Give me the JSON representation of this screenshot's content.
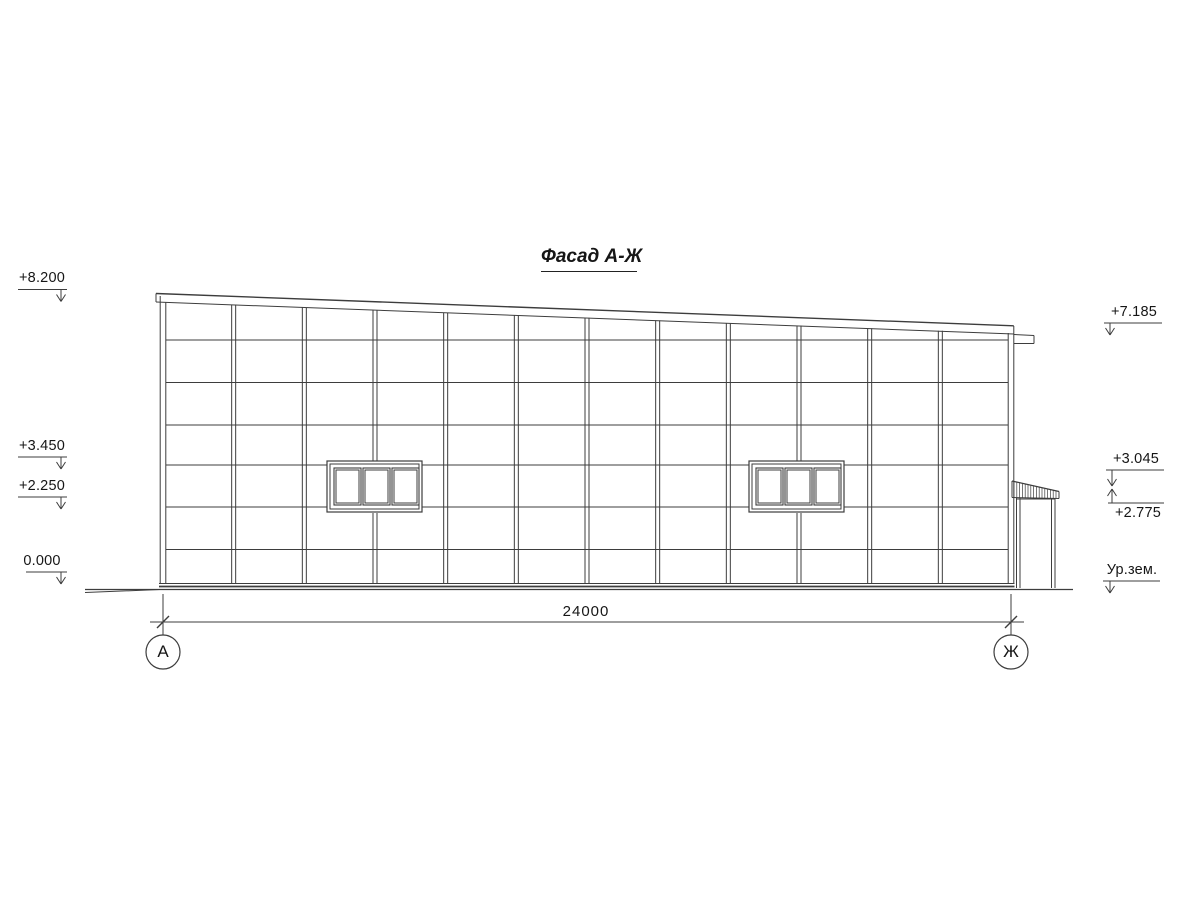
{
  "title": "Фасад А-Ж",
  "elevation_marks": {
    "left": [
      "+8.200",
      "+3.450",
      "+2.250",
      "0.000"
    ],
    "right": [
      "+7.185",
      "+3.045",
      "+2.775",
      "Ур.зем."
    ]
  },
  "dimension": {
    "overall_width": "24000"
  },
  "axis_bubbles": [
    "А",
    "Ж"
  ],
  "colors": {
    "line": "#3d3d3d",
    "text": "#161616",
    "background": "#ffffff"
  }
}
